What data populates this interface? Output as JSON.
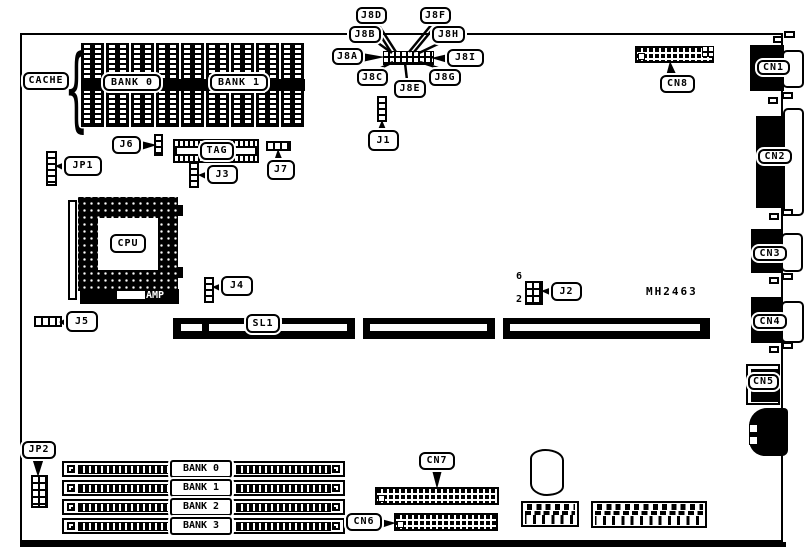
{
  "part_number": "MH2463",
  "colors": {
    "ink": "#000000",
    "paper": "#ffffff"
  },
  "labels": {
    "cache": "CACHE",
    "cache_bank0": "BANK 0",
    "cache_bank1": "BANK 1",
    "tag": "TAG",
    "cpu": "CPU",
    "amp": "AMP",
    "jp1": "JP1",
    "jp2": "JP2",
    "j1": "J1",
    "j2": "J2",
    "j3": "J3",
    "j4": "J4",
    "j5": "J5",
    "j6": "J6",
    "j7": "J7",
    "j8a": "J8A",
    "j8b": "J8B",
    "j8c": "J8C",
    "j8d": "J8D",
    "j8e": "J8E",
    "j8f": "J8F",
    "j8g": "J8G",
    "j8h": "J8H",
    "j8i": "J8I",
    "j2_pin_top": "6",
    "j2_pin_bottom": "2",
    "sl1": "SL1",
    "simm_bank0": "BANK 0",
    "simm_bank1": "BANK 1",
    "simm_bank2": "BANK 2",
    "simm_bank3": "BANK 3",
    "cn1": "CN1",
    "cn2": "CN2",
    "cn3": "CN3",
    "cn4": "CN4",
    "cn5": "CN5",
    "cn6": "CN6",
    "cn7": "CN7",
    "cn8": "CN8"
  }
}
